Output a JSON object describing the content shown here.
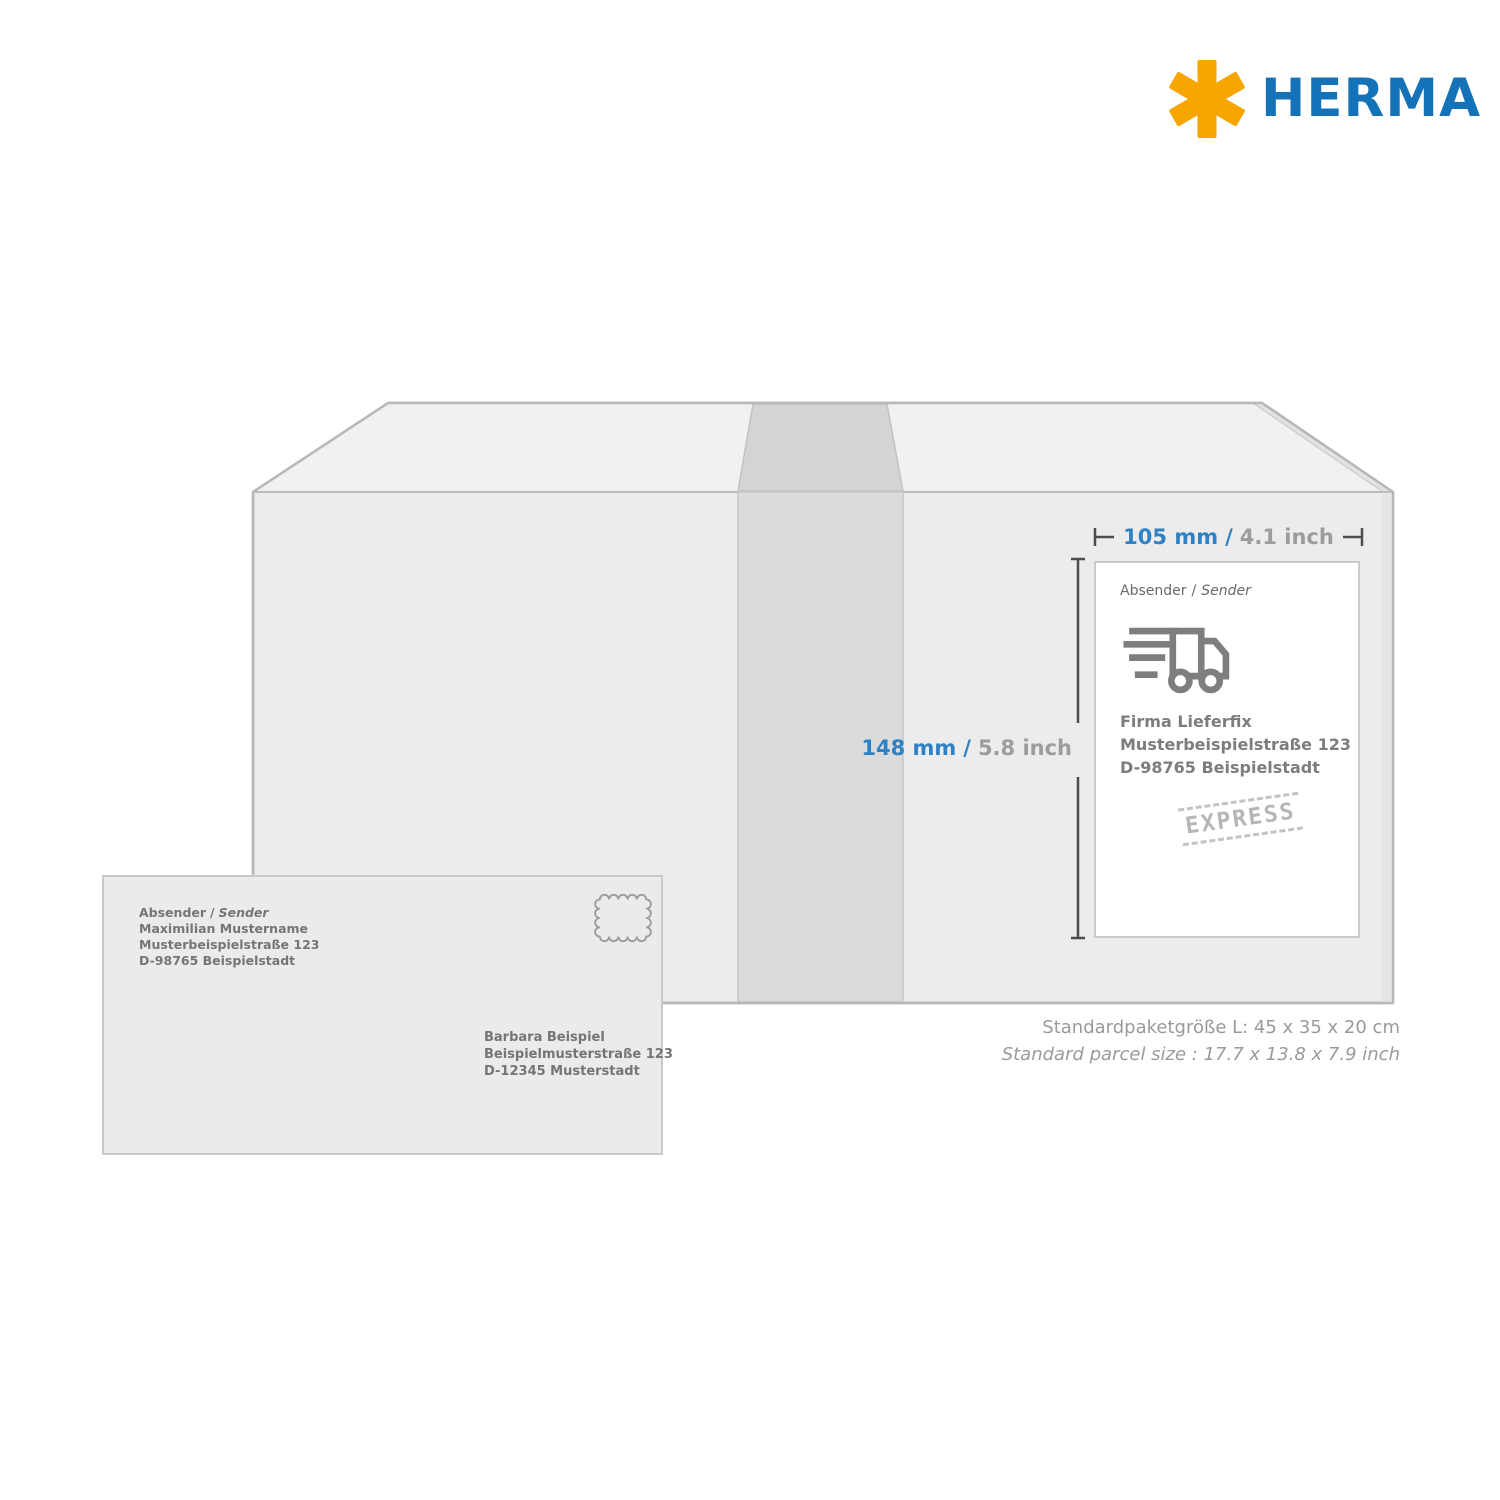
{
  "logo": {
    "brand": "HERMA",
    "asterisk_color": "#F7A600",
    "brand_color": "#1372B8"
  },
  "colors": {
    "dimension_blue": "#2E81C4",
    "dimension_gray": "#9C9C9C",
    "box_front": "#ECECEC",
    "box_top": "#F1F1F1",
    "tape": "#DBDBDB",
    "outline": "#B8B8B8",
    "icon_gray": "#7E7E7E"
  },
  "dim_width": {
    "metric": "105 mm",
    "slash": "/",
    "imperial": "4.1 inch"
  },
  "dim_height": {
    "metric": "148 mm",
    "slash": "/",
    "imperial": "5.8 inch"
  },
  "label": {
    "caption_de": "Absender",
    "caption_sep": "/",
    "caption_en": "Sender",
    "truck_icon": "delivery-truck-icon",
    "address": [
      "Firma Lieferfix",
      "Musterbeispielstraße 123",
      "D-98765 Beispielstadt"
    ],
    "stamp_text": "EXPRESS"
  },
  "envelope": {
    "caption_de": "Absender",
    "caption_sep": "/",
    "caption_en": "Sender",
    "sender": [
      "Maximilian Mustername",
      "Musterbeispielstraße 123",
      "D-98765 Beispielstadt"
    ],
    "recipient": [
      "Barbara Beispiel",
      "Beispielmusterstraße 123",
      "D-12345 Musterstadt"
    ]
  },
  "footer": {
    "line1": "Standardpaketgröße L: 45 x 35 x 20 cm",
    "line2": "Standard parcel size : 17.7 x 13.8 x 7.9 inch"
  }
}
